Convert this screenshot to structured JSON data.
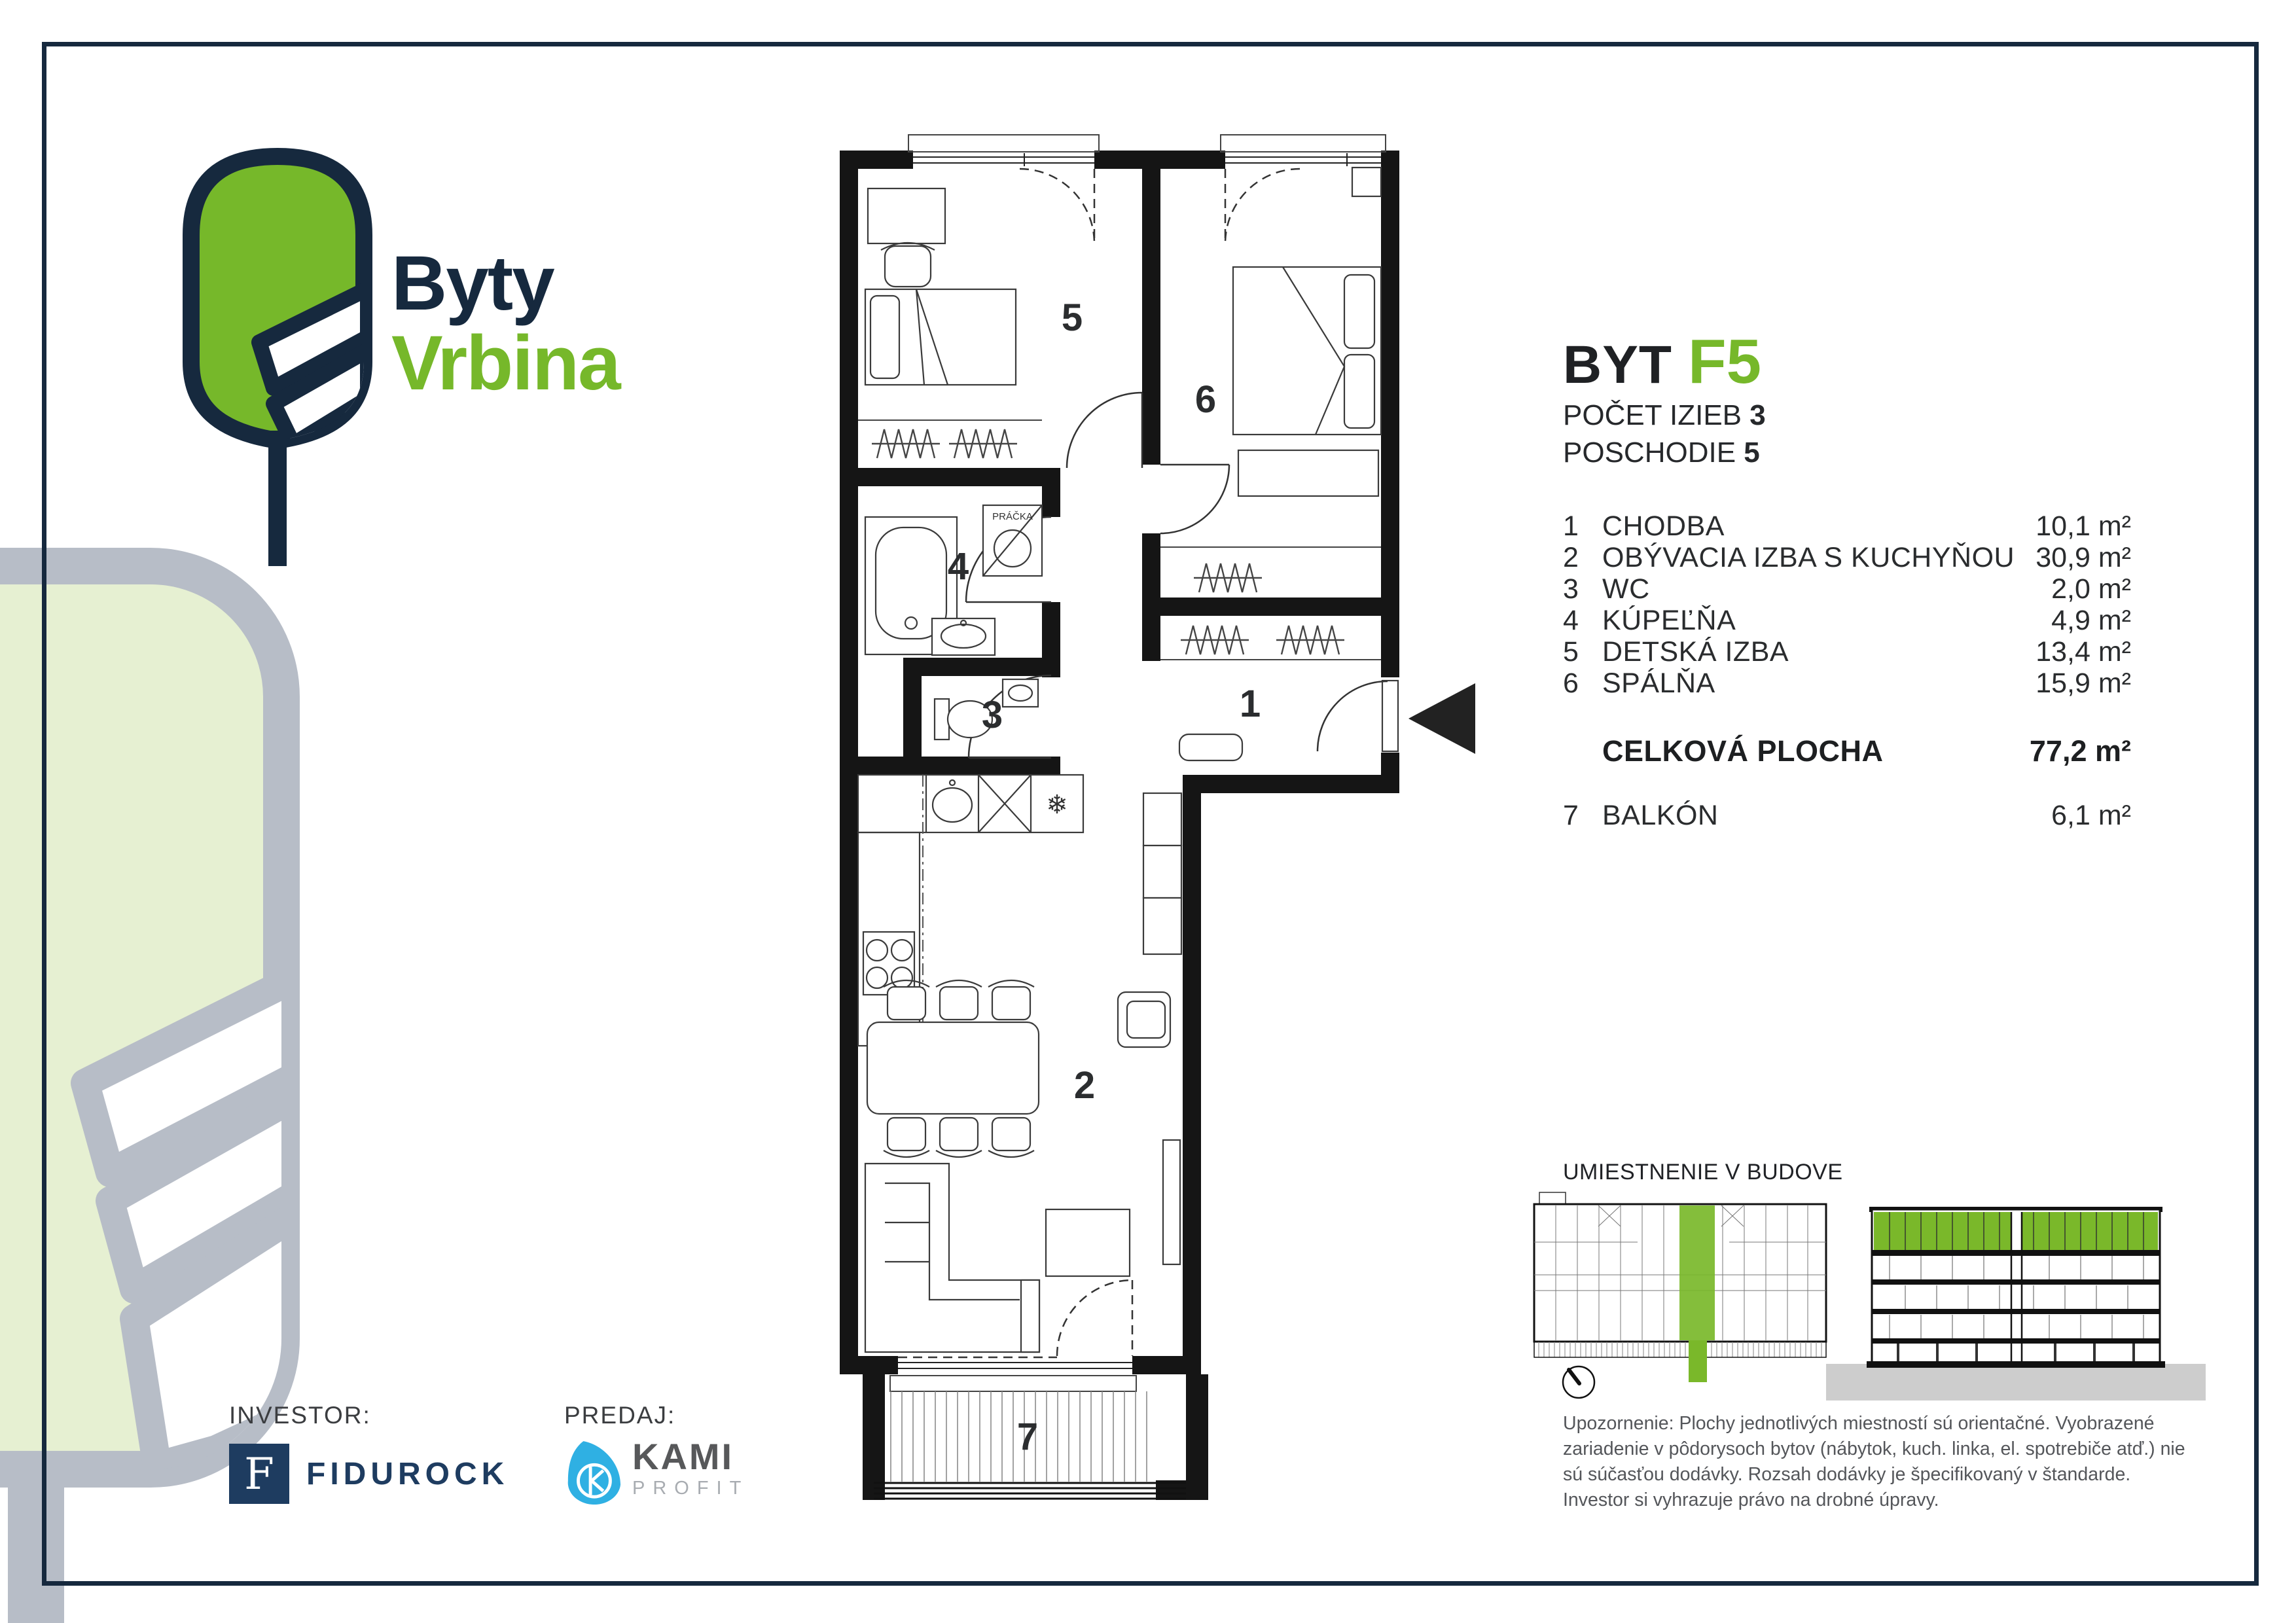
{
  "logo": {
    "line1": "Byty",
    "line2": "Vrbina"
  },
  "header": {
    "byt_label": "BYT",
    "unit": "F5",
    "rooms_label": "POČET IZIEB",
    "rooms_value": "3",
    "floor_label": "POSCHODIE",
    "floor_value": "5"
  },
  "legend": {
    "rooms": [
      {
        "num": "1",
        "label": "CHODBA",
        "area": "10,1 m²"
      },
      {
        "num": "2",
        "label": "OBÝVACIA IZBA S KUCHYŇOU",
        "area": "30,9 m²"
      },
      {
        "num": "3",
        "label": "WC",
        "area": "2,0 m²"
      },
      {
        "num": "4",
        "label": "KÚPEĽŇA",
        "area": "4,9 m²"
      },
      {
        "num": "5",
        "label": "DETSKÁ IZBA",
        "area": "13,4 m²"
      },
      {
        "num": "6",
        "label": "SPÁLŇA",
        "area": "15,9 m²"
      }
    ],
    "total_label": "CELKOVÁ PLOCHA",
    "total_area": "77,2 m²",
    "balcony": {
      "num": "7",
      "label": "BALKÓN",
      "area": "6,1 m²"
    }
  },
  "plan": {
    "labels": {
      "r1": "1",
      "r2": "2",
      "r3": "3",
      "r4": "4",
      "r5": "5",
      "r6": "6",
      "r7": "7"
    },
    "pracka": "PRÁČKA"
  },
  "icons": {
    "snowflake": "❄"
  },
  "location": {
    "title": "UMIESTNENIE V BUDOVE"
  },
  "disclaimer": "Upozornenie: Plochy jednotlivých miestností sú orientačné. Vyobrazené zariadenie v pôdorysoch bytov (nábytok, kuch. linka, el. spotrebiče atď.) nie sú súčasťou dodávky. Rozsah dodávky je špecifikovaný v štandarde. Investor si vyhrazuje právo na drobné úpravy.",
  "footer": {
    "investor_label": "INVESTOR:",
    "investor_monogram": "F",
    "investor_name": "FIDUROCK",
    "predaj_label": "PREDAJ:",
    "predaj_name": "KAMI",
    "predaj_sub": "PROFIT"
  },
  "colors": {
    "navy": "#16293e",
    "green": "#76b82a",
    "kami_blue": "#2fb0e3",
    "watermark_gray": "#b7bdc7",
    "watermark_green": "#e6f0d2"
  }
}
